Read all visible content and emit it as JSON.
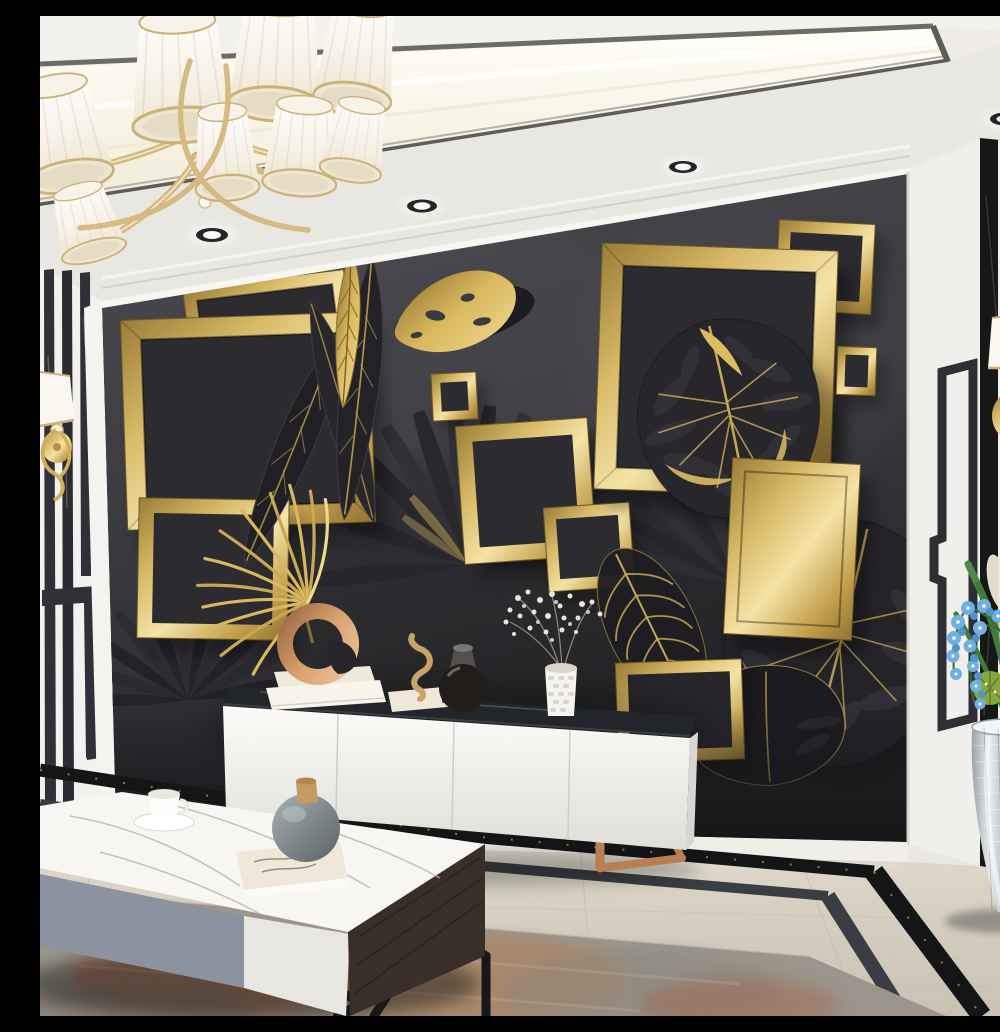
{
  "meta": {
    "title": "Modern living room with black and gold 3D botanical feature wall",
    "description": "Photorealistic interior: white coved ceiling with warm LED strip, gold curved-arm chandelier with eight white pleated shades, four recessed downlights, a charcoal feature wall decorated with 3D gold square frames and black-and-gold tropical leaves, white TV console with black marble top and copper sled legs, marble coffee table with grey and white drawers, striped black-and-white side walls with gold sconces, beige marble floor with double black inlay border, abstract grey-rust rug, and a silver mosaic floor vase holding blue orchids."
  },
  "palette": {
    "ceiling": "#efece7",
    "cove_light": "#fffdf2",
    "trim_dark": "#5c5c58",
    "wall_charcoal": "#38383d",
    "wall_deep": "#232327",
    "gold": "#c9a854",
    "gold_bright": "#f0dc9c",
    "white_molding": "#f2f0ec",
    "marble_black": "#17171a",
    "floor_beige": "#d8d1c3",
    "floor_inlay": "#141517",
    "rug_grey": "#9b958b",
    "rug_rust": "#b3603c",
    "copper": "#c08456",
    "chrome": "#c6ccd0",
    "orchid_blue": "#5a9fd4",
    "leaf_green": "#4e8a44",
    "shade_white": "#faf7f0"
  },
  "scene": {
    "ceiling": {
      "type": "recessed cove with warm LED strip and dark metal trim",
      "downlight_count": 4,
      "chandelier": {
        "style": "gold curved-arm",
        "shade_count": 8,
        "shade_color": "white pleated with gold rims"
      }
    },
    "feature_wall": {
      "color": "charcoal grey",
      "motif": "3D gold square frames with tropical leaves",
      "frame_count": 11,
      "leaves": [
        "black banana leaves with gold veins",
        "gold banana leaf",
        "distressed gold leaf",
        "black fan palms",
        "gold palm frond",
        "black monstera with gold veins inside large frame",
        "skeleton leaf with gold ribs",
        "large black monstera lower right"
      ]
    },
    "side_walls": {
      "left": "white with vertical black marble stripes, greek-key inlay and gold sconce with white shade",
      "right": "white pilaster with black key inlay, black marble panels with white strip and gold sconce with white shade"
    },
    "furniture": {
      "tv_console": {
        "body": "white lacquer",
        "top": "black marble",
        "legs": "copper sled",
        "decor": [
          "copper ring sculpture on two cream books",
          "seahorse figurine on small books",
          "dark glass decanter",
          "white textured vase with baby's breath"
        ]
      },
      "coffee_table": {
        "top": "white marble",
        "fronts": [
          "grey-blue drawer",
          "white drawer",
          "dark walnut side"
        ],
        "legs": "black angular steel",
        "decor": [
          "white tea cup on saucer",
          "cream art book",
          "grey round vase with wooden stopper"
        ]
      }
    },
    "floor": {
      "material": "polished beige marble",
      "inlay": "double black border, outer strip gold-veined black marble",
      "rug": "abstract grey and rust"
    },
    "plant": {
      "vase": "silver mosaic floor vase",
      "contents": [
        "blue orchid sprays",
        "green palm blades",
        "white plume grass",
        "green cactus balls"
      ]
    }
  }
}
